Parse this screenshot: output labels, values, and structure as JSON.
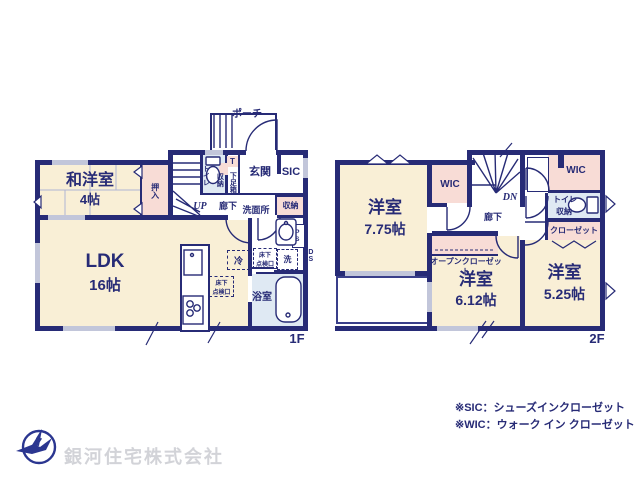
{
  "floor1": {
    "floor_label": "1F",
    "porch": "ポーチ",
    "entrance": "玄関",
    "sic": "SIC",
    "shoe_t": "T",
    "shoe_box": "下足箱",
    "toilet": "トイレ",
    "toilet_storage": "収納",
    "stairs_up": "UP",
    "hallway": "廊下",
    "washroom": "洗面所",
    "hall_storage": "収納",
    "washitsu_name": "和洋室",
    "washitsu_size": "4帖",
    "oshiire": "押入",
    "ldk_name": "LDK",
    "ldk_size": "16帖",
    "fridge": "冷",
    "hatch1": "床下\n点検口",
    "hatch2": "床下\n点検口",
    "washer": "洗",
    "ps": "PS",
    "ds": "DS",
    "bath": "浴室"
  },
  "floor2": {
    "floor_label": "2F",
    "wic_left": "WIC",
    "wic_right": "WIC",
    "stairs_dn": "DN",
    "hallway": "廊下",
    "toilet": "トイレ",
    "toilet_storage": "収納",
    "closet": "クローゼット",
    "open_closet": "オープンクローゼット",
    "room1_name": "洋室",
    "room1_size": "7.75帖",
    "room2_name": "洋室",
    "room2_size": "6.12帖",
    "room3_name": "洋室",
    "room3_size": "5.25帖"
  },
  "notes": {
    "sic": "※SIC：シューズインクローゼット",
    "wic": "※WIC：ウォーク イン クローゼット"
  },
  "company": {
    "name": "銀河住宅株式会社"
  },
  "colors": {
    "wall": "#272b76",
    "room_cream": "#f9efd6",
    "closet_pink": "#f8dcd6",
    "water_blue": "#dfe9f3",
    "window_gray": "#c2c6da",
    "logo_navy": "#2b3690"
  }
}
